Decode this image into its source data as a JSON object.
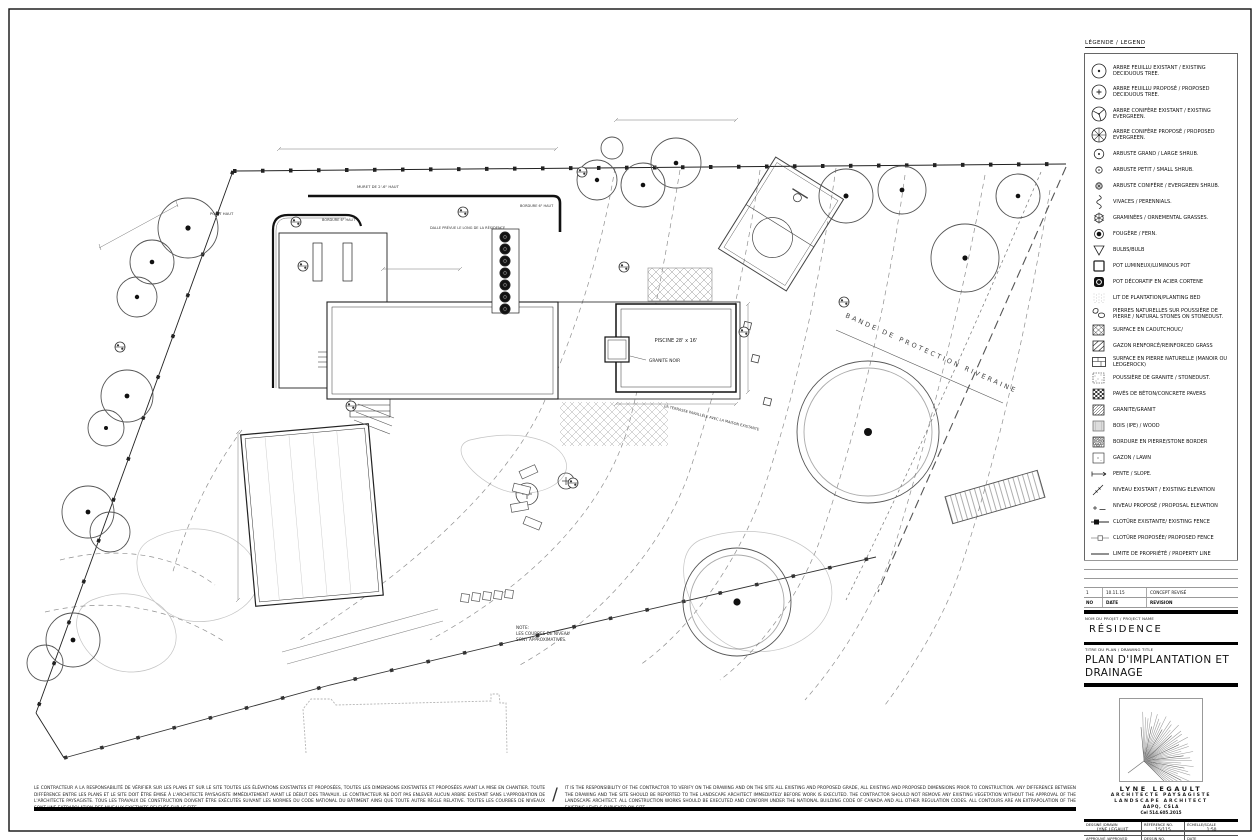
{
  "legend": {
    "title": "LÉGENDE / LEGEND",
    "items": [
      {
        "icon": "tree-deciduous-existing",
        "label": "ARBRE FEUILLU EXISTANT / EXISTING DECIDUOUS TREE."
      },
      {
        "icon": "tree-deciduous-proposed",
        "label": "ARBRE FEUILLU PROPOSÉ / PROPOSED DECIDUOUS TREE."
      },
      {
        "icon": "tree-evergreen-existing",
        "label": "ARBRE CONIFÈRE EXISTANT / EXISTING EVERGREEN."
      },
      {
        "icon": "tree-evergreen-proposed",
        "label": "ARBRE CONIFÈRE PROPOSÉ / PROPOSED EVERGREEN."
      },
      {
        "icon": "shrub-large",
        "label": "ARBUSTE GRAND / LARGE SHRUB."
      },
      {
        "icon": "shrub-small",
        "label": "ARBUSTE PETIT / SMALL SHRUB."
      },
      {
        "icon": "shrub-evergreen",
        "label": "ARBUSTE CONIFÈRE / EVERGREEN SHRUB."
      },
      {
        "icon": "perennials",
        "label": "VIVACES / PERENNIALS."
      },
      {
        "icon": "grasses",
        "label": "GRAMINÉES / ORNEMENTAL GRASSES."
      },
      {
        "icon": "fern",
        "label": "FOUGÈRE / FERN."
      },
      {
        "icon": "bulb",
        "label": "BULBS/BULB"
      },
      {
        "icon": "pot-luminous",
        "label": "POT LUMINEUX/LUMINOUS POT"
      },
      {
        "icon": "pot-corten",
        "label": "POT DÉCORATIF EN ACIER CORTENE"
      },
      {
        "icon": "planting-bed",
        "label": "LIT DE PLANTATION/PLANTING BED"
      },
      {
        "icon": "natural-stones",
        "label": "PIERRES NATURELLES SUR POUSSIÈRE DE PIERRE / NATURAL STONES ON STONEDUST."
      },
      {
        "icon": "rubber-surface",
        "label": "SURFACE EN CAOUTCHOUC/"
      },
      {
        "icon": "reinforced-grass",
        "label": "GAZON RENFORCÉ/REINFORCED GRASS"
      },
      {
        "icon": "stone-slab",
        "label": "SURFACE EN PIERRE NATURELLE (MANOIR OU LEDGEROCK)"
      },
      {
        "icon": "stonedust",
        "label": "POUSSIÈRE DE GRANITE / STONEDUST."
      },
      {
        "icon": "pavers",
        "label": "PAVÉS DE BÉTON/CONCRETE PAVERS"
      },
      {
        "icon": "granite",
        "label": "GRANITE/GRANIT"
      },
      {
        "icon": "wood",
        "label": "BOIS (IPE) / WOOD"
      },
      {
        "icon": "stone-border",
        "label": "BORDURE EN PIERRE/STONE BORDER"
      },
      {
        "icon": "lawn",
        "label": "GAZON / LAWN"
      },
      {
        "icon": "slope",
        "label": "PENTE / SLOPE."
      },
      {
        "icon": "elevation-existing",
        "label": "NIVEAU EXISTANT / EXISTING ELEVATION"
      },
      {
        "icon": "elevation-proposed",
        "label": "NIVEAU PROPOSÉ / PROPOSAL ELEVATION"
      },
      {
        "icon": "fence-existing",
        "label": "CLOTÛRE EXISTANTE/ EXISTING FENCE"
      },
      {
        "icon": "fence-proposed",
        "label": "CLOTÛRE PROPOSÉE/ PROPOSED FENCE"
      },
      {
        "icon": "property-line",
        "label": "LIMITE DE PROPRIÉTÉ / PROPERTY LINE"
      }
    ]
  },
  "plan": {
    "labels": {
      "pool": "PISCINE 28' x 16'",
      "pool_material": "GRANITE NOIR",
      "riverine_band": "BANDE DE PROTECTION RIVERAINE",
      "note_1": "NOTE:",
      "note_2": "LES COURBES DE NIVEAU",
      "note_3": "SONT APPROXIMATIVES.",
      "wall": "MURET DE 2'-6\" HAUT",
      "border": "BORDURE 6\" HAUT",
      "slab": "DALLE PRÉVUE LE LONG DE LA RÉSIDENCE",
      "high_point": "POINT HAUT",
      "terrace_note": "LA TERRASSE PARALLÈLE AVEC LA MAISON EXISTANTE"
    }
  },
  "titleblock": {
    "revision_table": {
      "rows": [
        {
          "no": "1",
          "date": "10.11.15",
          "revision": "CONCEPT REVISÉ"
        }
      ],
      "header": {
        "no": "NO",
        "date": "DATE",
        "revision": "REVISION"
      }
    },
    "project_label": "NOM DU PROJET / PROJECT NAME",
    "project_name": "RÉSIDENCE",
    "title_label": "TITRE DU PLAN / DRAWING TITLE",
    "drawing_title": "PLAN D'IMPLANTATION ET DRAINAGE",
    "architect": {
      "name": "LYNE LEGAULT",
      "role_fr": "ARCHITECTE PAYSAGISTE",
      "role_en": "LANDSCAPE ARCHITECT",
      "affiliation": "AAPQ, CSLA",
      "phone": "Cel 514.605.2015"
    },
    "info_table": {
      "drawn_label": "DESSINÉ /DRAWN",
      "drawn_value": "LYNE LEGAULT",
      "reference_label": "RÉFÉRENCE NO.",
      "reference_value": "15/115",
      "scale_label": "ÉCHELLE/SCALE",
      "scale_value": "1:50",
      "approved_label": "APPROUVÉ /APPROVED",
      "approved_value": "LYNE LEGAULT",
      "drawing_no_label": "DESSIN NO.",
      "drawing_no_value": "2/4",
      "date_label": "DATE",
      "date_value": "OCTOBRE 2015"
    }
  },
  "disclaimer": {
    "french": "LE CONTRACTEUR A LA RESPONSABILITÉ DE VÉRIFIER SUR LES PLANS ET SUR LE SITE TOUTES LES ÉLÉVATIONS EXISTANTES ET PROPOSÉES, TOUTES LES DIMENSIONS EXISTANTES ET PROPOSÉES AVANT LA MISE EN CHANTIER.  TOUTE DIFFÉRENCE ENTRE LES PLANS ET LE SITE DOIT ÊTRE ÉMISE À L'ARCHITECTE PAYSAGISTE IMMÉDIATEMENT AVANT LE DÉBUT DES TRAVAUX.  LE CONTRACTEUR NE DOIT PAS ENLEVER AUCUN ARBRE EXISTANT SANS L'APPROBATION DE L'ARCHITECTE PAYSAGISTE.  TOUS LES TRAVAUX DE CONSTRUCTION DOIVENT ÊTRE EXÉCUTÉS SUIVANT LES NORMES DU CODE NATIONAL DU BÂTIMENT AINSI QUE TOUTE AUTRE RÈGLE RELATIVE.  TOUTES LES COURBES DE NIVEAUX SONT UNE EXTRAPOLATION DES NIVEAUX EXISTANTS RELEVÉS SUR LE SITE.",
    "english": "IT IS THE RESPONSIBILITY OF THE CONTRACTOR TO VERIFY ON THE DRAWING AND ON THE SITE ALL EXISTING AND PROPOSED GRADE, ALL EXISTING AND PROPOSED DIMENSIONS PRIOR TO CONSTRUCTION.  ANY DIFFERENCE BETWEEN THE DRAWING AND THE SITE SHOULD BE REPORTED TO THE LANDSCAPE ARCHITECT IMMEDIATELY BEFORE WORK IS EXECUTED. THE CONTRACTOR SHOULD NOT REMOVE ANY EXISTING VEGETATION WITHOUT THE APPROVAL OF THE LANDSCAPE ARCHITECT.  ALL CONSTRUCTION WORKS SHOULD BE EXECUTED AND CONFORM UNDER THE NATIONAL BUILDING CODE OF CANADA AND ALL OTHER REGULATION CODES.  ALL CONTOURS ARE AN EXTRAPOLATION OF THE EXISTING LEVELS SURVEYED ON SITE."
  }
}
